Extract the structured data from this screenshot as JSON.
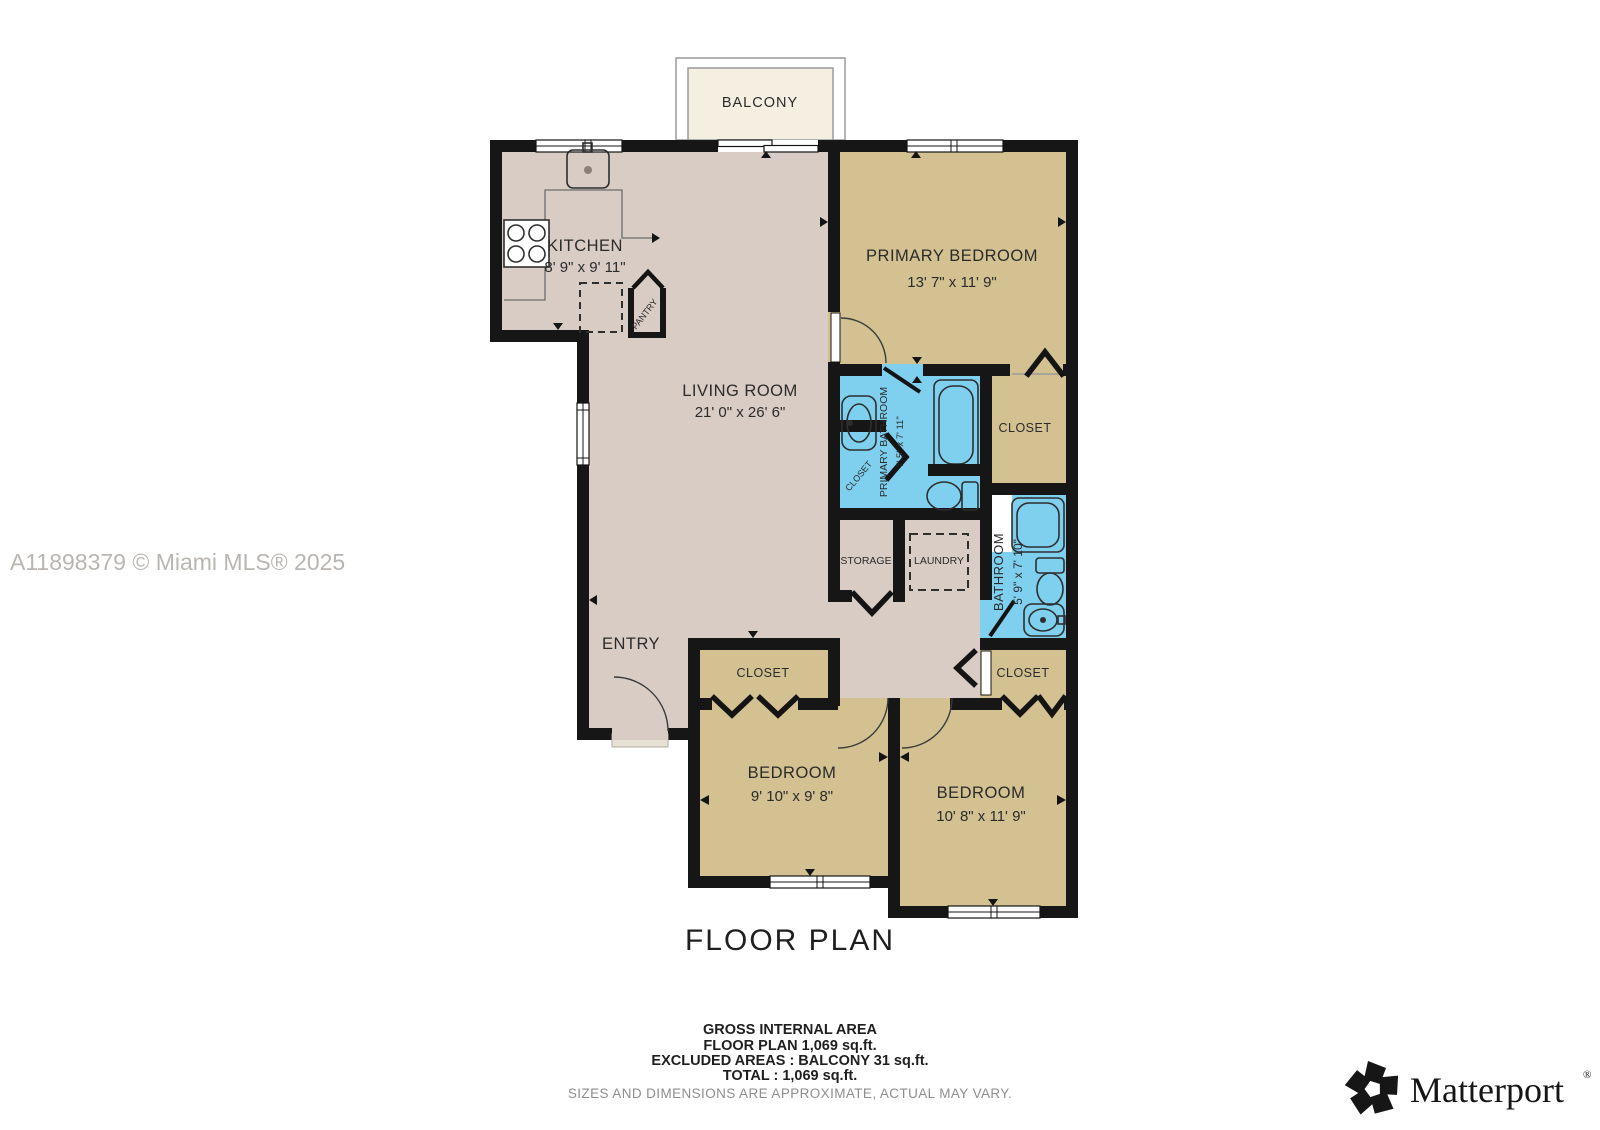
{
  "title": "FLOOR PLAN",
  "watermark": "A11898379 © Miami MLS® 2025",
  "rooms": {
    "balcony": {
      "name": "BALCONY"
    },
    "kitchen": {
      "name": "KITCHEN",
      "dims": "8' 9\" x 9' 11\""
    },
    "living": {
      "name": "LIVING ROOM",
      "dims": "21' 0\" x 26' 6\""
    },
    "primary_bedroom": {
      "name": "PRIMARY BEDROOM",
      "dims": "13' 7\" x 11' 9\""
    },
    "primary_bathroom": {
      "name": "PRIMARY BATHROOM",
      "dims": "7' 5\" x 7' 11\""
    },
    "primary_closet": {
      "name": "CLOSET"
    },
    "small_closet": {
      "name": "CLOSET"
    },
    "pantry": {
      "name": "PANTRY"
    },
    "storage": {
      "name": "STORAGE"
    },
    "laundry": {
      "name": "LAUNDRY"
    },
    "bathroom": {
      "name": "BATHROOM",
      "dims": "5' 9\" x 7' 10\""
    },
    "entry": {
      "name": "ENTRY"
    },
    "closet_bed1": {
      "name": "CLOSET"
    },
    "closet_bed2": {
      "name": "CLOSET"
    },
    "bedroom1": {
      "name": "BEDROOM",
      "dims": "9' 10\" x 9' 8\""
    },
    "bedroom2": {
      "name": "BEDROOM",
      "dims": "10' 8\" x 11' 9\""
    }
  },
  "footer": {
    "line1": "GROSS INTERNAL AREA",
    "line2": "FLOOR PLAN 1,069 sq.ft.",
    "line3": "EXCLUDED AREAS :  BALCONY 31 sq.ft.",
    "line4": "TOTAL :  1,069 sq.ft.",
    "disclaimer": "SIZES AND DIMENSIONS ARE APPROXIMATE, ACTUAL MAY VARY."
  },
  "brand": {
    "name": "Matterport",
    "reg": "®"
  },
  "colors": {
    "floor_living": "#d9ccc4",
    "floor_bedroom": "#d3c192",
    "floor_bathroom": "#7fd0ee",
    "floor_balcony": "#f4efe1",
    "wall": "#161616",
    "watermark_gray": "#b9b6b2",
    "disclaimer_gray": "#8e8e8e"
  }
}
